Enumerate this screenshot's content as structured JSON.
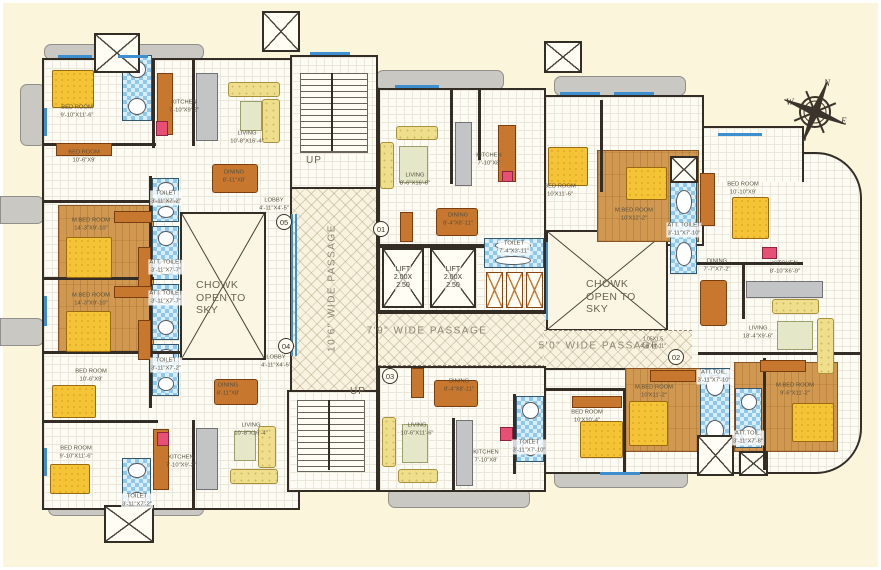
{
  "plan": {
    "chowk": {
      "l1": "CHOWK",
      "l2": "OPEN TO",
      "l3": "SKY"
    },
    "passages": {
      "vertical": "10'6\" WIDE PASSAGE",
      "mid": "7'9\" WIDE PASSAGE",
      "right": "5'0\" WIDE PASSAGE"
    },
    "stairs": {
      "up": "UP"
    },
    "lift": {
      "l1": "LIFT",
      "l2": "2.00X",
      "l3": "2.50"
    },
    "compass": {
      "n": "N",
      "e": "E",
      "s": "S",
      "w": "W"
    },
    "units": [
      {
        "num": "05"
      },
      {
        "num": "01"
      },
      {
        "num": "04"
      },
      {
        "num": "03"
      },
      {
        "num": "02"
      }
    ],
    "annotation": {
      "l1": "1.05X1.5",
      "l2": "4'-0\"X4'-11\""
    },
    "rooms": [
      {
        "name": "BED ROOM",
        "dim": "9'-10\"X11'-6\""
      },
      {
        "name": "BED ROOM",
        "dim": "10'-6\"X9'"
      },
      {
        "name": "KITCHEN",
        "dim": "7'-10\"X9'-2\""
      },
      {
        "name": "LIVING",
        "dim": "10'-8\"X16'-4\""
      },
      {
        "name": "DINING",
        "dim": "8'-11\"X8'"
      },
      {
        "name": "LOBBY",
        "dim": "4'-11\"X4'-5\""
      },
      {
        "name": "M.BED ROOM",
        "dim": "14'-3\"X9'-10\""
      },
      {
        "name": "M.BED ROOM",
        "dim": "14'-3\"X9'-10\""
      },
      {
        "name": "TOILET",
        "dim": "3'-11\"X7'-2\""
      },
      {
        "name": "ATT. TOILET",
        "dim": "3'-11\"X7'-7\""
      },
      {
        "name": "ATT. TOILET",
        "dim": "3'-11\"X7'-7\""
      },
      {
        "name": "TOILET",
        "dim": "3'-11\"X7'-2\""
      },
      {
        "name": "BED ROOM",
        "dim": "10'-6\"X9'"
      },
      {
        "name": "BED ROOM",
        "dim": "9'-10\"X11'-6\""
      },
      {
        "name": "TOILET",
        "dim": "3'-11\"X7'-2\""
      },
      {
        "name": "KITCHEN",
        "dim": "7'-10\"X9'-2\""
      },
      {
        "name": "DINING",
        "dim": "8'-11\"X8'"
      },
      {
        "name": "LIVING",
        "dim": "10'-8\"X16'-4\""
      },
      {
        "name": "LOBBY",
        "dim": "4'-11\"X4'-5\""
      },
      {
        "name": "LIVING",
        "dim": "8'-6\"X16'-6\""
      },
      {
        "name": "KITCHEN",
        "dim": "7'-10\"X8'"
      },
      {
        "name": "DINING",
        "dim": "8'-4\"X8'-11\""
      },
      {
        "name": "TOILET",
        "dim": "7'-4\"X3'-11\""
      },
      {
        "name": "BED ROOM",
        "dim": "10'X11'-6\""
      },
      {
        "name": "M.BED ROOM",
        "dim": "10'X12'-2\""
      },
      {
        "name": "ATT. TOILET",
        "dim": "3'-11\"X7'-10\""
      },
      {
        "name": "BED ROOM",
        "dim": "10'-10\"X9'"
      },
      {
        "name": "DINING",
        "dim": "7'-7\"X7'-2\""
      },
      {
        "name": "KITCHEN",
        "dim": "8'-10\"X6'-9\""
      },
      {
        "name": "LIVING",
        "dim": "18'-4\"X9'-6\""
      },
      {
        "name": "DINING",
        "dim": "8'-4\"X8'-11\""
      },
      {
        "name": "LIVING",
        "dim": "10'-6\"X11'-6\""
      },
      {
        "name": "KITCHEN",
        "dim": "7'-10\"X8'"
      },
      {
        "name": "TOILET",
        "dim": "3'-11\"X7'-10\""
      },
      {
        "name": "BED ROOM",
        "dim": "10'X10'-4\""
      },
      {
        "name": "M.BED ROOM",
        "dim": "10'X11'-2\""
      },
      {
        "name": "ATT.TOIL.",
        "dim": "3'-11\"X7'-10\""
      },
      {
        "name": "ATT.TOIL.",
        "dim": "3'-11\"X7'-8\""
      },
      {
        "name": "M.BED ROOM",
        "dim": "9'-6\"X11'-2\""
      }
    ]
  }
}
